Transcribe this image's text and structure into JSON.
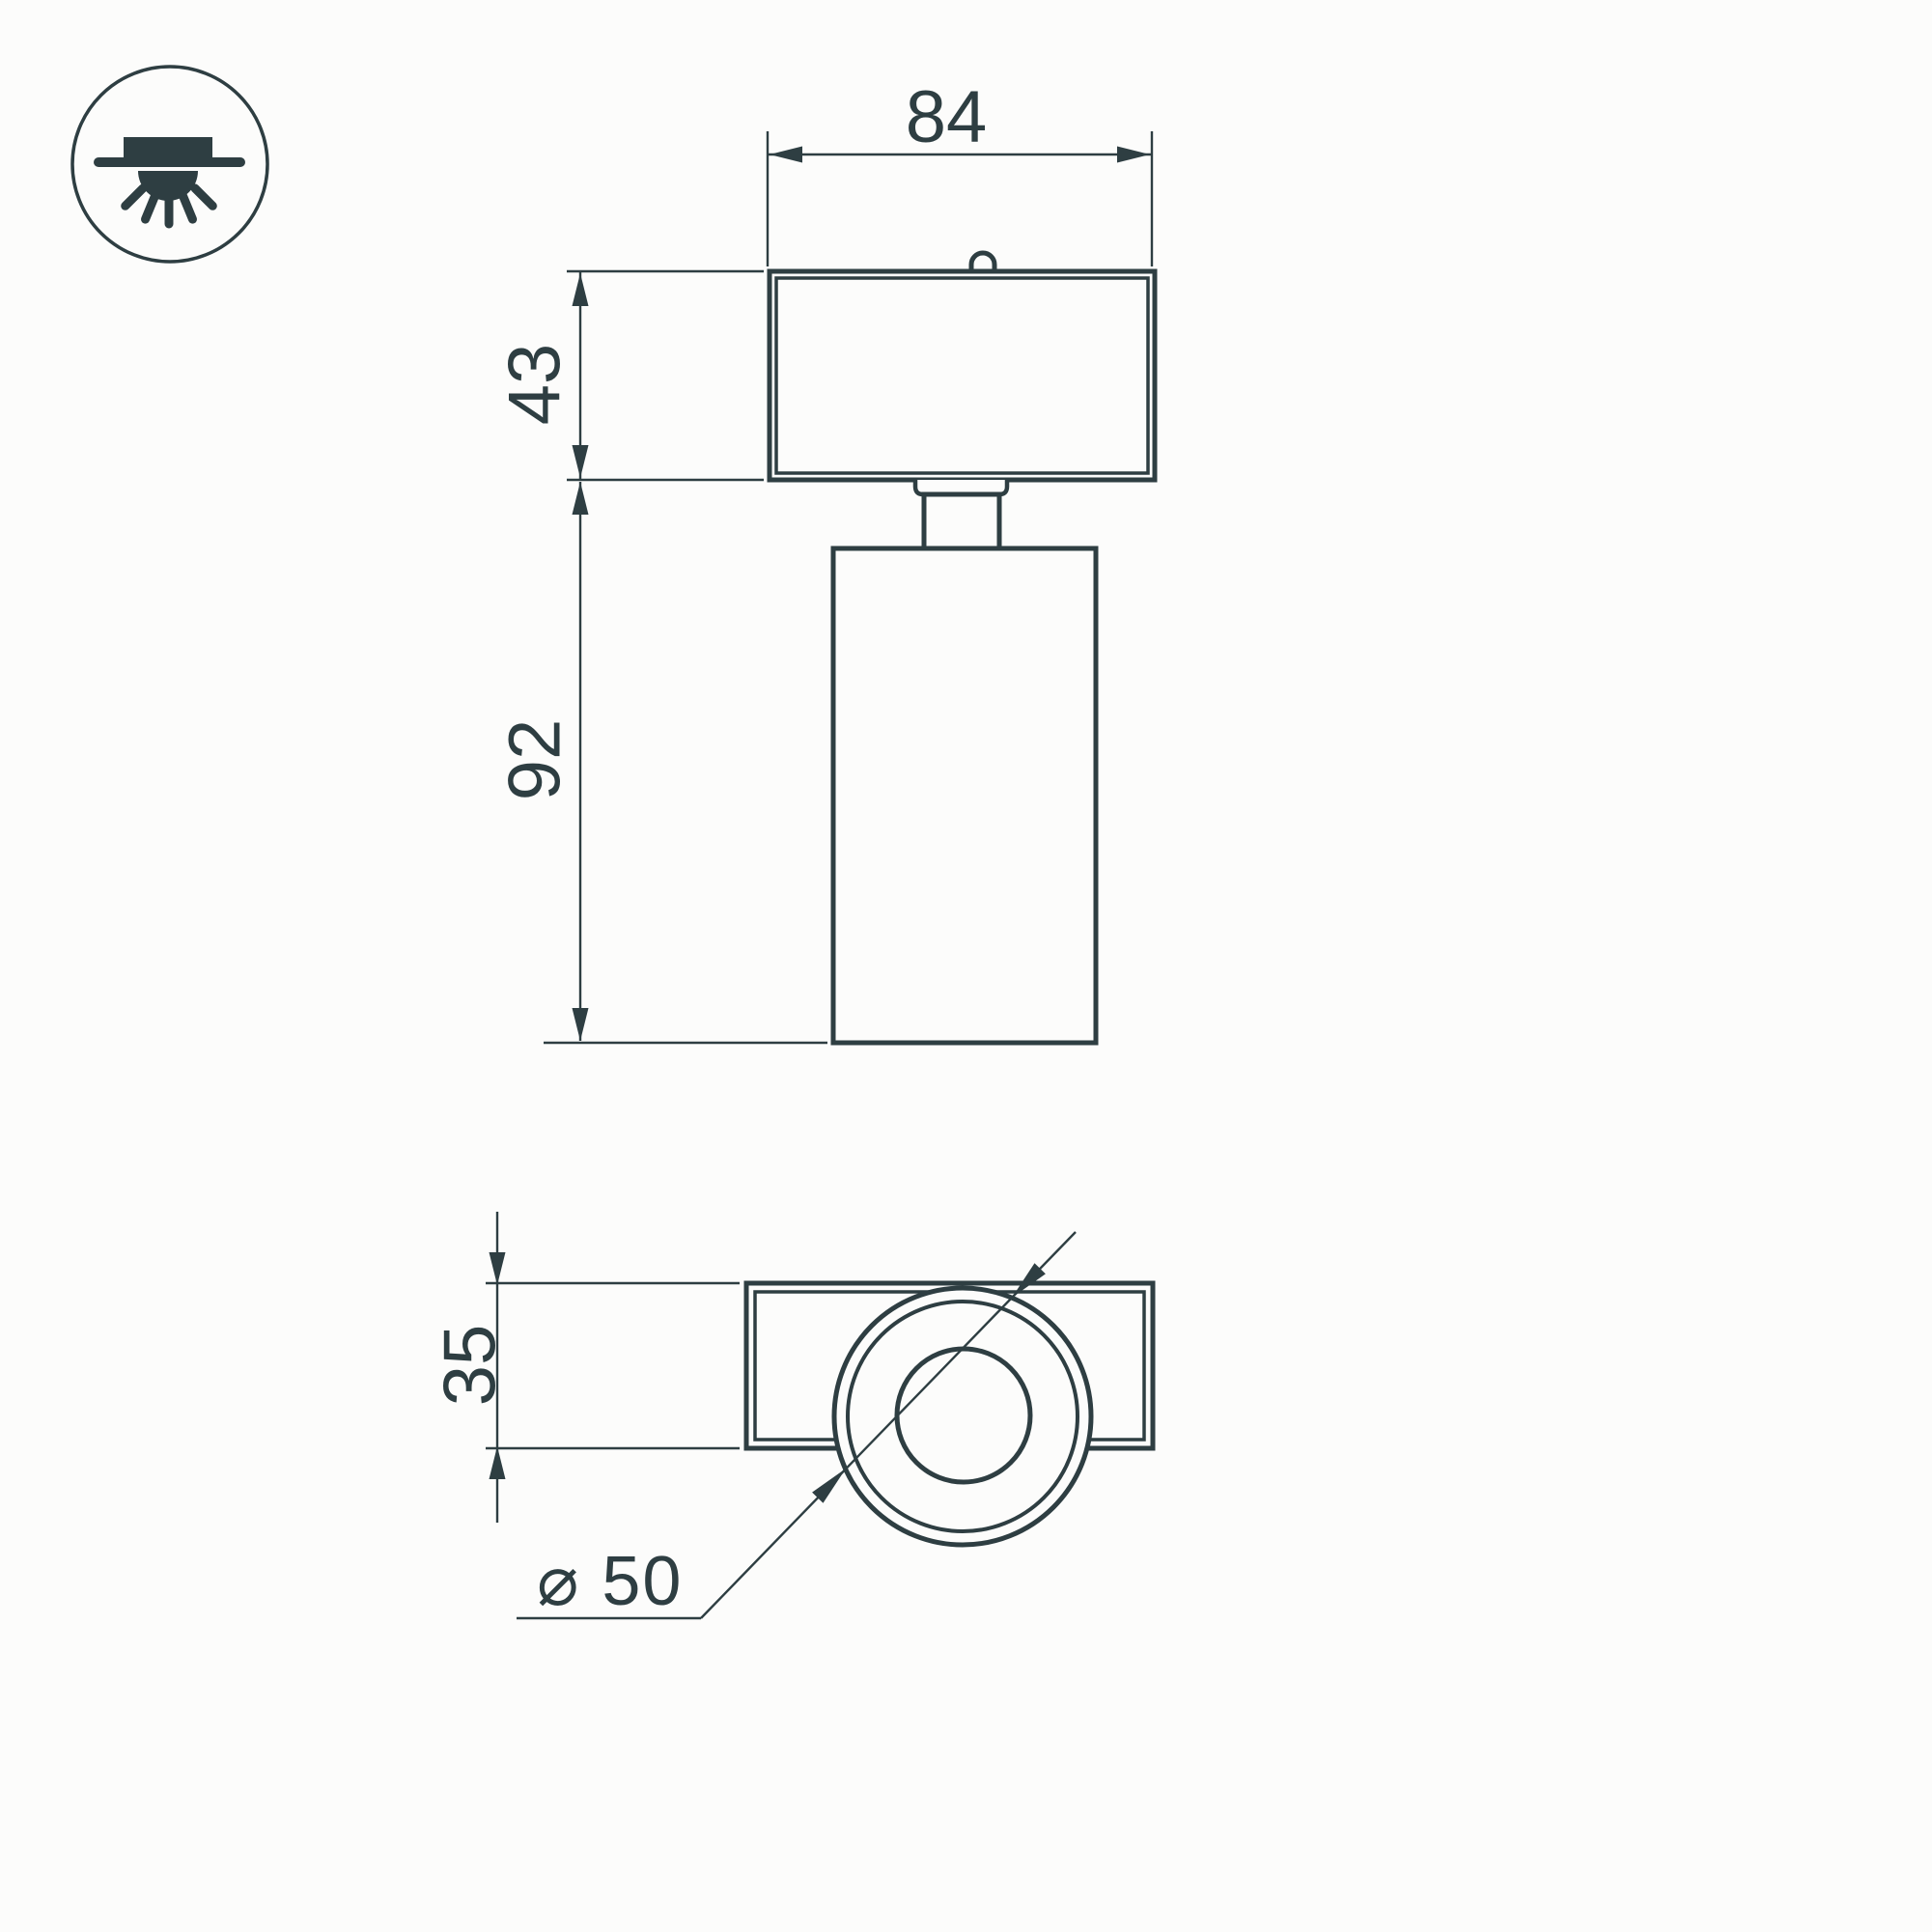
{
  "palette": {
    "line_color": "#2e3e42",
    "background_color": "#fcfcfb"
  },
  "icon": {
    "name": "surface-ceiling-light-icon"
  },
  "front_view": {
    "width_dim": "84",
    "base_height_dim": "43",
    "body_height_dim": "92"
  },
  "bottom_view": {
    "depth_dim": "35",
    "diameter_dim": "⌀ 50"
  }
}
